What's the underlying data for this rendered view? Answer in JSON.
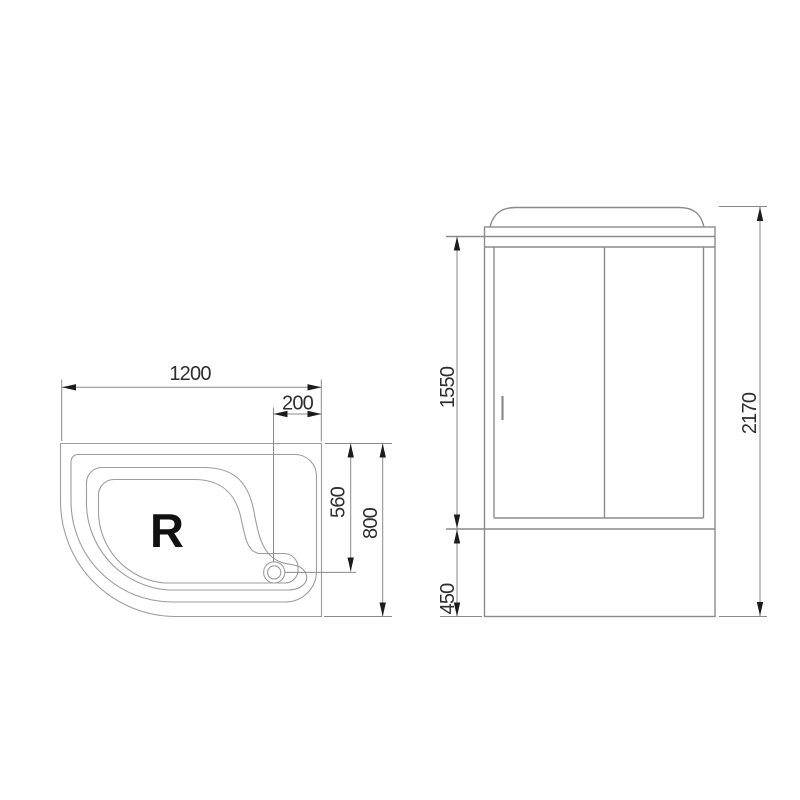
{
  "drawing": {
    "top_view": {
      "orientation": "R",
      "width": "1200",
      "depth": "800",
      "drain_offset": "200",
      "drain_depth": "560"
    },
    "front_view": {
      "door_height": "1550",
      "base_height": "450",
      "total_height": "2170"
    },
    "colors": {
      "bg": "#ffffff",
      "outline": "#8b8b8b",
      "contour": "#9d9d9d",
      "dimension": "#8a8a8a",
      "arrow": "#1c1c1c",
      "text": "#2e2e2e",
      "label": "#111111"
    }
  }
}
